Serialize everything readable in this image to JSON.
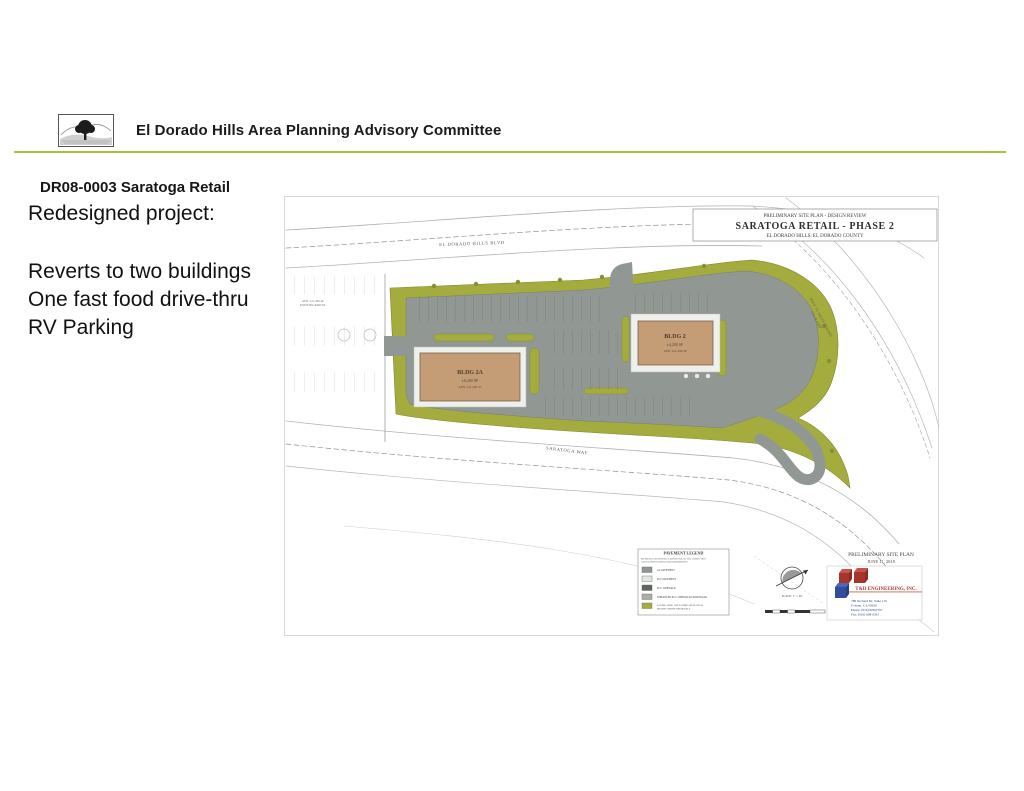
{
  "header": {
    "title": "El Dorado Hills Area Planning Advisory Committee",
    "rule_color": "#a6c23e",
    "logo_name": "oak-tree-logo"
  },
  "slide": {
    "project_id_line": "DR08-0003 Saratoga Retail",
    "heading": "Redesigned project:",
    "bullets": [
      "Reverts to two buildings",
      "One fast food drive-thru",
      "RV Parking"
    ]
  },
  "plan": {
    "title_block": {
      "line1": "PRELIMINARY SITE PLAN - DESIGN REVIEW",
      "line2": "SARATOGA RETAIL  - PHASE 2",
      "line3": "EL DORADO HILLS, EL DORADO COUNTY"
    },
    "roads": {
      "north": "EL DORADO HILLS BLVD",
      "south": "SARATOGA WAY",
      "east_line1": "HWY 50 WEST BOUND",
      "east_line2": "ON-RAMP"
    },
    "buildings": [
      {
        "name": "BLDG 2A",
        "size": "±8,200 SF",
        "apn": "APN: 121-290-37"
      },
      {
        "name": "BLDG 2",
        "size": "±4,200 SF",
        "apn": "APN: 121-290-38"
      }
    ],
    "annotations": {
      "west_parcel_line1": "APN: 121-290-40",
      "west_parcel_line2": "EXISTING PARCEL"
    },
    "legend": {
      "title": "PAVEMENT LEGEND",
      "note1": "REFERENCE GEOTECHNICAL REPORT FOR ALL FILL COMPACTION",
      "note2": "AND PAVEMENT COMPACTION REQUIREMENTS",
      "items": [
        {
          "label": "AC PAVEMENT",
          "color": "#8f9792"
        },
        {
          "label": "PCC PAVEMENT",
          "color": "#e4e7e2"
        },
        {
          "label": "PCC SIDEWALK",
          "color": "#5f645f"
        },
        {
          "label": "ENHANCED PCC SIDEWALK/CROSSWALK",
          "color": "#a9aea6"
        },
        {
          "label": "LANDSCAPING, SEE LANDSCAPE PLANS &",
          "label2": "SPECIFICATIONS FOR DETAILS",
          "color": "#a4ac3d"
        }
      ]
    },
    "stamp": {
      "line1": "PRELIMINARY SITE PLAN",
      "line2": "JUNE 11, 2018"
    },
    "firm": {
      "name": "T&D ENGINEERING, INC.",
      "address1": "789 Orchard Dr, Suite 110",
      "address2": "Folsom, CA 95630",
      "phone": "Phone: (916) 608-0707",
      "fax": "Fax: (916) 608-0291"
    },
    "scale_label": "SCALE: 1\" = 40'"
  },
  "colors": {
    "landscape_olive": "#a4ac3d",
    "pavement_gray": "#919894",
    "building_tan": "#c49d77",
    "sidewalk_light": "#eef0ec"
  }
}
